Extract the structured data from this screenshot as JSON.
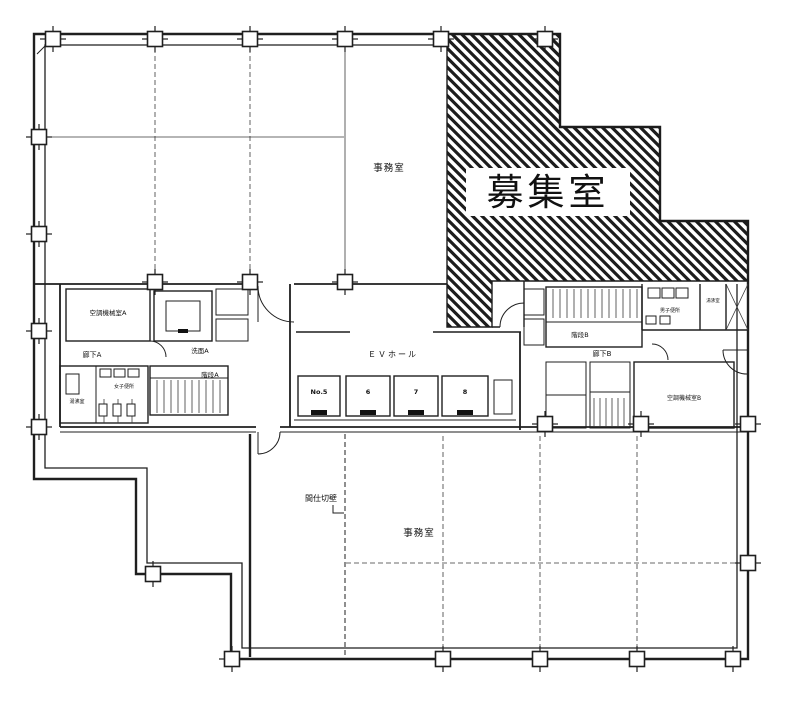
{
  "colors": {
    "line": "#1f1f1f",
    "background": "#ffffff",
    "hatch": "#1f1f1f"
  },
  "areas": {
    "office_top": "事務室",
    "vacant_room": "募集室",
    "office_bottom": "事務室",
    "ev_hall": "ＥＶホール"
  },
  "elevators": [
    "No.5",
    "6",
    "7",
    "8"
  ],
  "left_core": {
    "machine_room": "空調機械室A",
    "corridor": "廊下A",
    "washroom": "洗面A",
    "stair": "階段A",
    "womens_wc": "女子便所",
    "hot_water": "湯沸室"
  },
  "right_core": {
    "stair": "階段B",
    "corridor": "廊下B",
    "mens_wc": "男子便所",
    "hot_water": "湯沸室",
    "machine_room": "空調機械室B"
  },
  "annotations": {
    "partition": "間仕切壁"
  }
}
